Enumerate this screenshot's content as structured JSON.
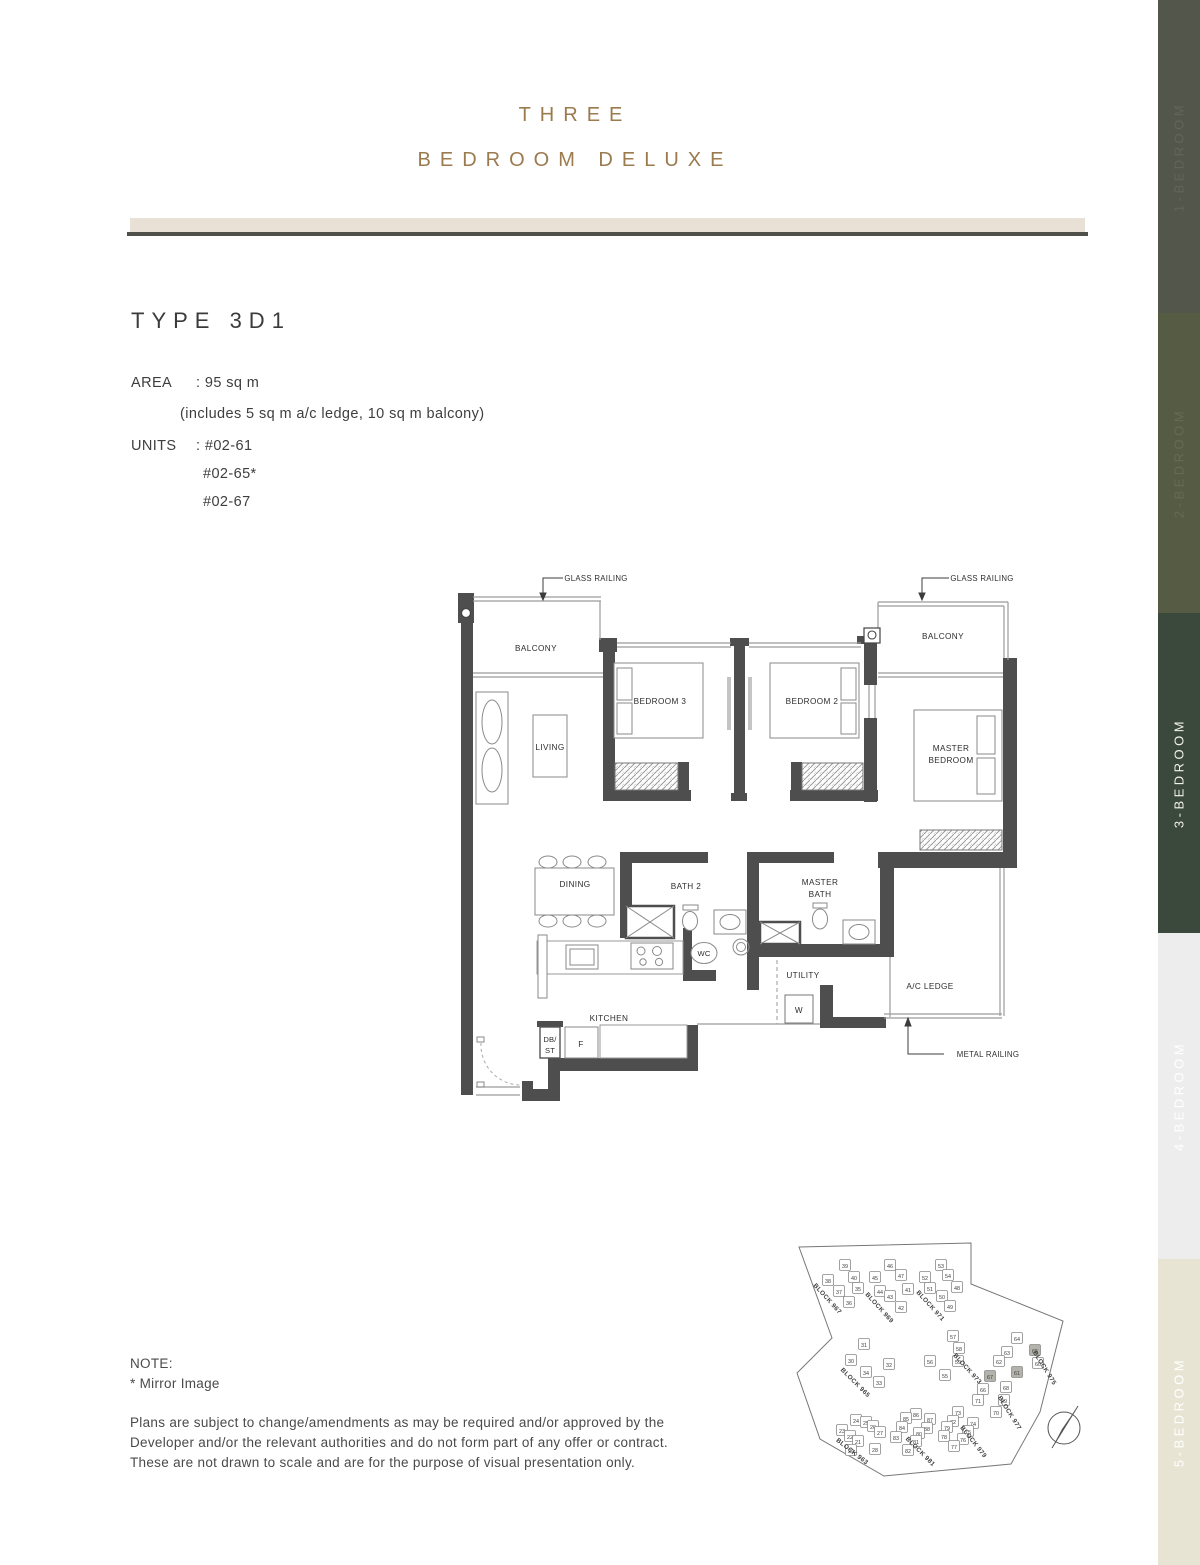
{
  "header": {
    "title_line1": "THREE",
    "title_line2": "BEDROOM DELUXE"
  },
  "unit_info": {
    "type_title": "TYPE 3D1",
    "area": {
      "label": "AREA",
      "value": ": 95 sq m",
      "note": "(includes 5 sq m a/c ledge, 10 sq m balcony)"
    },
    "units": {
      "label": "UNITS",
      "first": ": #02-61",
      "rest": [
        "#02-65*",
        "#02-67"
      ]
    }
  },
  "floorplan": {
    "glass_railing_left": "GLASS RAILING",
    "glass_railing_right": "GLASS RAILING",
    "metal_railing": "METAL RAILING",
    "balcony_left": "BALCONY",
    "balcony_right": "BALCONY",
    "living": "LIVING",
    "bedroom3": "BEDROOM 3",
    "bedroom2": "BEDROOM 2",
    "master_bedroom_l1": "MASTER",
    "master_bedroom_l2": "BEDROOM",
    "dining": "DINING",
    "bath2": "BATH 2",
    "master_bath_l1": "MASTER",
    "master_bath_l2": "BATH",
    "wc": "WC",
    "utility": "UTILITY",
    "ac_ledge": "A/C LEDGE",
    "kitchen": "KITCHEN",
    "washer": "W",
    "fridge": "F",
    "db_l1": "DB/",
    "db_l2": "ST"
  },
  "notes": {
    "title": "NOTE:",
    "mirror": "*   Mirror Image",
    "lines": [
      "Plans are subject to change/amendments as may be required and/or approved by the",
      "Developer and/or the relevant authorities and do not form part of any offer or contract.",
      "These are not drawn to scale and are for the purpose of visual presentation only."
    ]
  },
  "sidebar": {
    "items": [
      {
        "label": "1-BEDROOM",
        "bg": "#53574b",
        "fg": "#61655a",
        "active": false
      },
      {
        "label": "2-BEDROOM",
        "bg": "#565b44",
        "fg": "#666b51",
        "active": false
      },
      {
        "label": "3-BEDROOM",
        "bg": "#3b483c",
        "fg": "#f2f2ec",
        "active": true
      },
      {
        "label": "4-BEDROOM",
        "bg": "#ecedec",
        "fg": "#ffffff",
        "active": false
      },
      {
        "label": "5-BEDROOM",
        "bg": "#e8e4d4",
        "fg": "#ffffff",
        "active": false
      }
    ]
  },
  "site_plan": {
    "highlight_color": "#b3b3ab",
    "blocks": [
      {
        "name": "BLOCK 967",
        "x": 826,
        "y": 1300,
        "rot": 48
      },
      {
        "name": "BLOCK 969",
        "x": 878,
        "y": 1309,
        "rot": 48
      },
      {
        "name": "BLOCK 971",
        "x": 929,
        "y": 1307,
        "rot": 48
      },
      {
        "name": "BLOCK 965",
        "x": 854,
        "y": 1384,
        "rot": 45
      },
      {
        "name": "BLOCK 973",
        "x": 966,
        "y": 1370,
        "rot": 48
      },
      {
        "name": "BLOCK 975",
        "x": 1043,
        "y": 1369,
        "rot": 58
      },
      {
        "name": "BLOCK 977",
        "x": 1008,
        "y": 1414,
        "rot": 58
      },
      {
        "name": "BLOCK 979",
        "x": 972,
        "y": 1443,
        "rot": 52
      },
      {
        "name": "BLOCK 981",
        "x": 919,
        "y": 1453,
        "rot": 45
      },
      {
        "name": "BLOCK 963",
        "x": 851,
        "y": 1453,
        "rot": 38
      }
    ],
    "units": [
      {
        "no": "39",
        "x": 845,
        "y": 1266
      },
      {
        "no": "40",
        "x": 854,
        "y": 1278
      },
      {
        "no": "38",
        "x": 828,
        "y": 1281
      },
      {
        "no": "37",
        "y": 1292,
        "x": 839
      },
      {
        "no": "36",
        "x": 849,
        "y": 1303
      },
      {
        "no": "35",
        "x": 858,
        "y": 1289
      },
      {
        "no": "46",
        "x": 890,
        "y": 1266
      },
      {
        "no": "47",
        "x": 901,
        "y": 1276
      },
      {
        "no": "45",
        "x": 875,
        "y": 1278
      },
      {
        "no": "44",
        "x": 880,
        "y": 1292
      },
      {
        "no": "43",
        "x": 890,
        "y": 1297
      },
      {
        "no": "41",
        "x": 908,
        "y": 1290
      },
      {
        "no": "42",
        "x": 901,
        "y": 1308
      },
      {
        "no": "53",
        "x": 941,
        "y": 1266
      },
      {
        "no": "54",
        "x": 948,
        "y": 1276
      },
      {
        "no": "52",
        "x": 925,
        "y": 1278
      },
      {
        "no": "51",
        "x": 930,
        "y": 1289
      },
      {
        "no": "48",
        "x": 957,
        "y": 1288
      },
      {
        "no": "50",
        "x": 942,
        "y": 1297
      },
      {
        "no": "49",
        "x": 950,
        "y": 1307
      },
      {
        "no": "31",
        "x": 864,
        "y": 1345
      },
      {
        "no": "30",
        "x": 851,
        "y": 1361
      },
      {
        "no": "32",
        "x": 889,
        "y": 1365
      },
      {
        "no": "34",
        "x": 866,
        "y": 1373
      },
      {
        "no": "33",
        "x": 879,
        "y": 1383
      },
      {
        "no": "57",
        "x": 953,
        "y": 1337
      },
      {
        "no": "58",
        "x": 959,
        "y": 1349
      },
      {
        "no": "56",
        "x": 930,
        "y": 1362
      },
      {
        "no": "59",
        "x": 958,
        "y": 1362
      },
      {
        "no": "55",
        "x": 945,
        "y": 1376
      },
      {
        "no": "64",
        "x": 1017,
        "y": 1339
      },
      {
        "no": "63",
        "x": 1007,
        "y": 1353
      },
      {
        "no": "65",
        "x": 1035,
        "y": 1351,
        "hl": true
      },
      {
        "no": "62",
        "x": 999,
        "y": 1362
      },
      {
        "no": "60",
        "x": 1038,
        "y": 1364
      },
      {
        "no": "61",
        "x": 1017,
        "y": 1373,
        "hl": true
      },
      {
        "no": "67",
        "x": 990,
        "y": 1377,
        "hl": true
      },
      {
        "no": "66",
        "x": 983,
        "y": 1390
      },
      {
        "no": "68",
        "x": 1006,
        "y": 1388
      },
      {
        "no": "69",
        "x": 1004,
        "y": 1401
      },
      {
        "no": "71",
        "x": 978,
        "y": 1401
      },
      {
        "no": "70",
        "x": 996,
        "y": 1413
      },
      {
        "no": "73",
        "x": 958,
        "y": 1413
      },
      {
        "no": "72",
        "x": 953,
        "y": 1422
      },
      {
        "no": "74",
        "x": 973,
        "y": 1424
      },
      {
        "no": "79",
        "x": 947,
        "y": 1428
      },
      {
        "no": "75",
        "x": 968,
        "y": 1432
      },
      {
        "no": "78",
        "x": 944,
        "y": 1437
      },
      {
        "no": "76",
        "x": 963,
        "y": 1440
      },
      {
        "no": "77",
        "x": 954,
        "y": 1447
      },
      {
        "no": "86",
        "x": 916,
        "y": 1415
      },
      {
        "no": "85",
        "x": 906,
        "y": 1419
      },
      {
        "no": "87",
        "x": 930,
        "y": 1420
      },
      {
        "no": "84",
        "x": 902,
        "y": 1428
      },
      {
        "no": "88",
        "x": 927,
        "y": 1429
      },
      {
        "no": "83",
        "x": 896,
        "y": 1438
      },
      {
        "no": "80",
        "x": 919,
        "y": 1434
      },
      {
        "no": "81",
        "x": 916,
        "y": 1442
      },
      {
        "no": "82",
        "x": 908,
        "y": 1451
      },
      {
        "no": "24",
        "x": 856,
        "y": 1421
      },
      {
        "no": "25",
        "x": 866,
        "y": 1423
      },
      {
        "no": "26",
        "x": 873,
        "y": 1427
      },
      {
        "no": "23",
        "x": 842,
        "y": 1431
      },
      {
        "no": "22",
        "x": 850,
        "y": 1437
      },
      {
        "no": "27",
        "x": 880,
        "y": 1433
      },
      {
        "no": "21",
        "x": 858,
        "y": 1442
      },
      {
        "no": "29",
        "x": 851,
        "y": 1451
      },
      {
        "no": "28",
        "x": 875,
        "y": 1450
      }
    ]
  },
  "colors": {
    "title_gold": "#9b7a4e",
    "band_beige": "#e9e1d5",
    "band_line": "#50504a",
    "wall_gray": "#4e4e4e",
    "active_tab": "#3b483c"
  }
}
